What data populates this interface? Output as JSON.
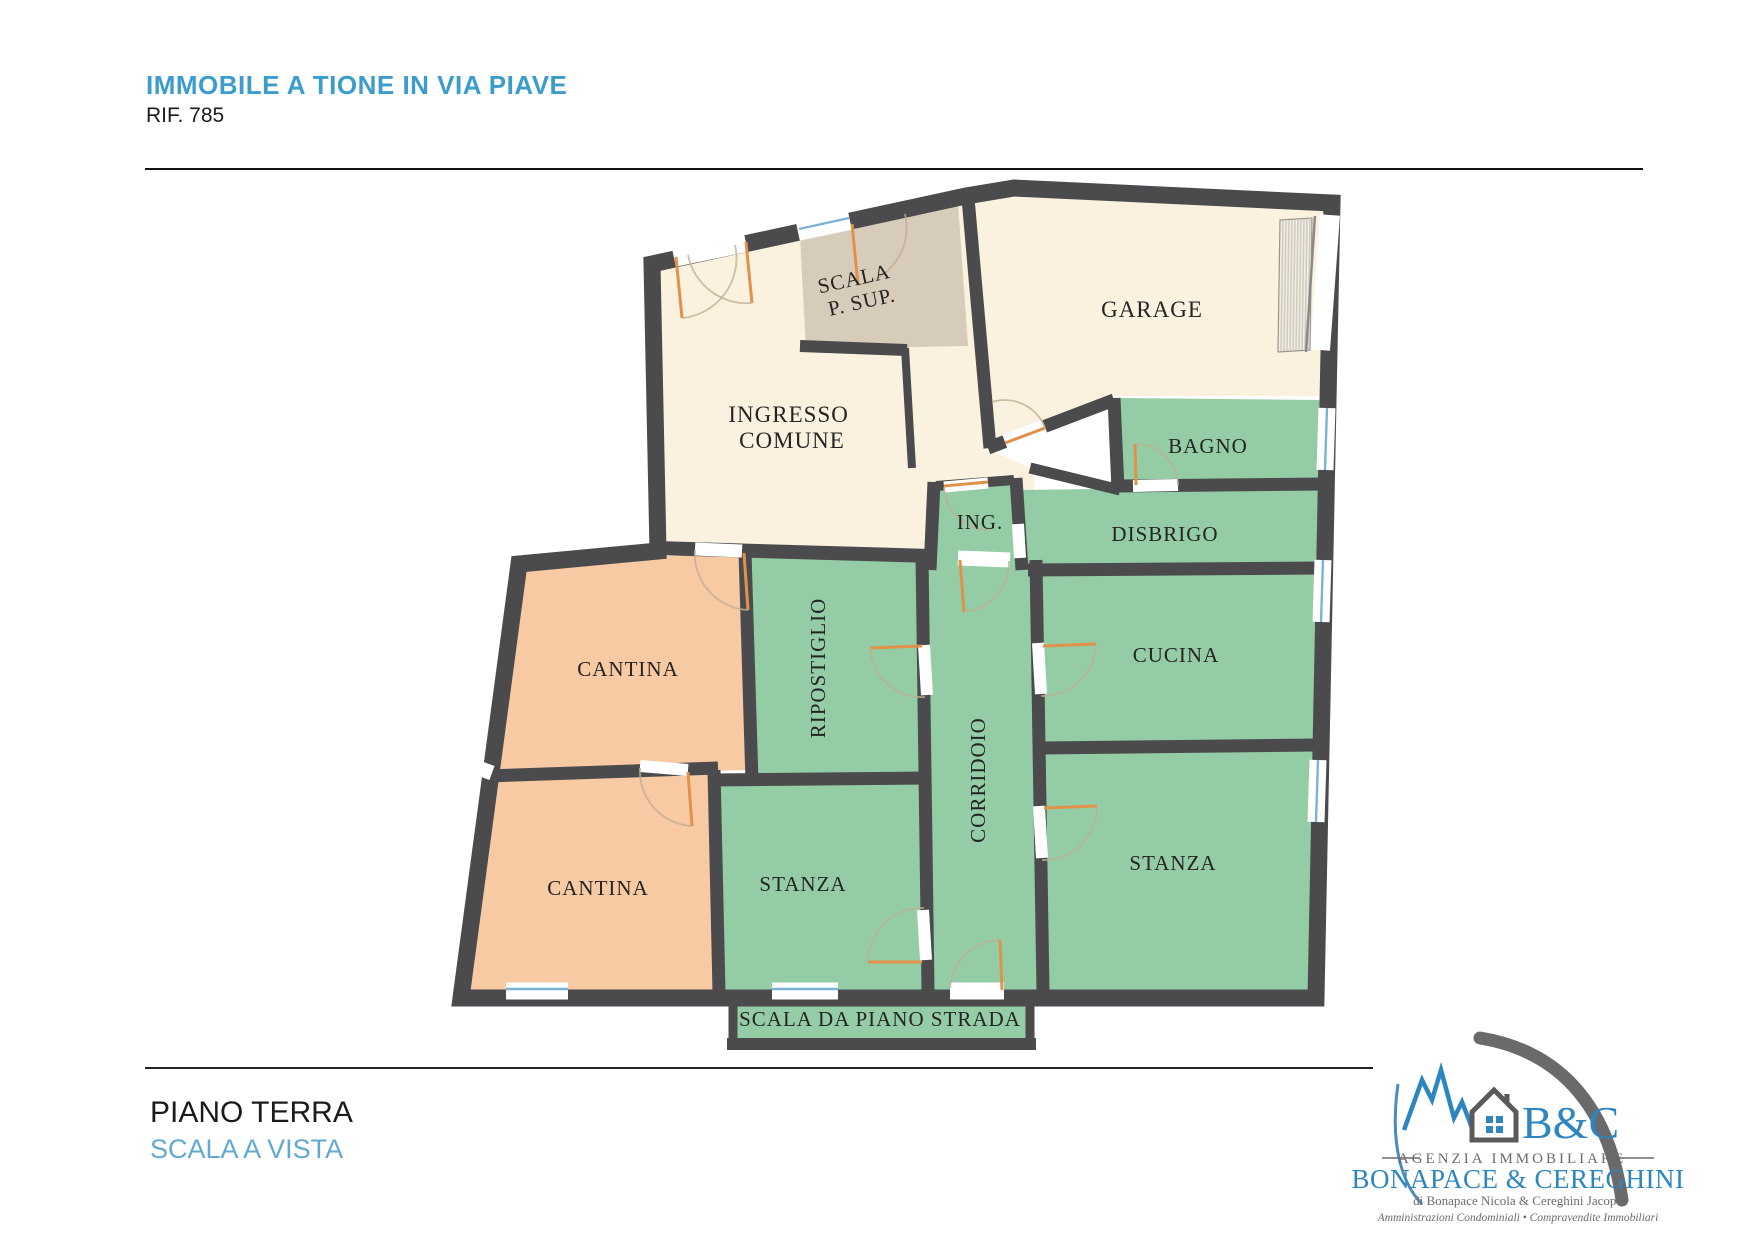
{
  "header": {
    "title": "IMMOBILE A TIONE IN VIA PIAVE",
    "reference": "RIF. 785"
  },
  "footer": {
    "floor": "PIANO TERRA",
    "note": "SCALA A VISTA"
  },
  "floorplan": {
    "rooms": {
      "scala_sup_line1": "SCALA",
      "scala_sup_line2": "P. SUP.",
      "garage": "GARAGE",
      "ingresso_line1": "INGRESSO",
      "ingresso_line2": "COMUNE",
      "bagno": "BAGNO",
      "ing": "ING.",
      "disbrigo": "DISBRIGO",
      "cantina_upper": "CANTINA",
      "ripostiglio": "RIPOSTIGLIO",
      "corridoio": "CORRIDOIO",
      "cucina": "CUCINA",
      "stanza_right": "STANZA",
      "cantina_lower": "CANTINA",
      "stanza_center": "STANZA",
      "scala_strada": "SCALA DA PIANO STRADA"
    },
    "colors": {
      "wall": "#4b4b4d",
      "common_area": "#faf2de",
      "stairwell": "#d7ccba",
      "apartment": "#94cda5",
      "cellar": "#f7caa4",
      "window": "#7ab3d6",
      "door": "#e0924a"
    }
  },
  "logo": {
    "initials": "B&C",
    "agency_type": "AGENZIA IMMOBILIARE",
    "agency_name": "BONAPACE & CEREGHINI",
    "owners": "di Bonapace Nicola & Cereghini Jacopo",
    "services": "Amministrazioni Condominiali • Compravendite Immobiliari"
  }
}
